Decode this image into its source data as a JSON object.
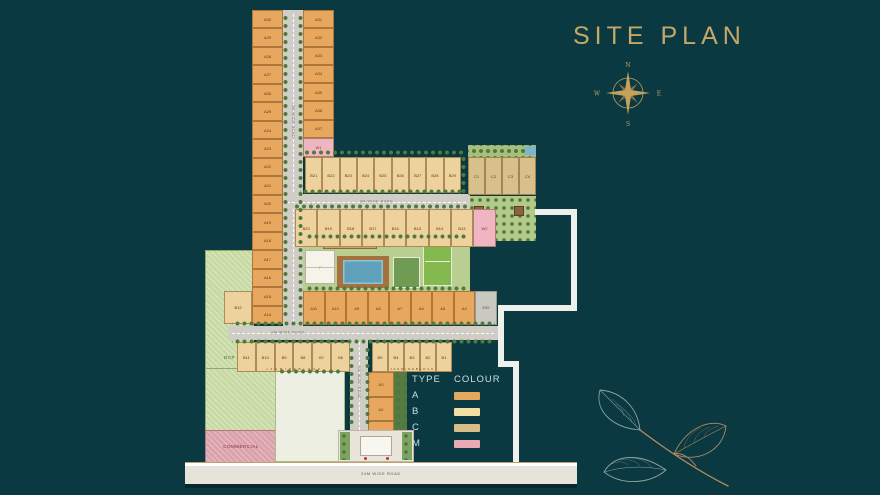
{
  "title": "SITE PLAN",
  "compass": {
    "north": "N",
    "east": "E",
    "south": "S",
    "west": "W"
  },
  "legend": {
    "type_header": "TYPE",
    "colour_header": "COLOUR",
    "rows": [
      {
        "type": "A",
        "color": "#e2a95e"
      },
      {
        "type": "B",
        "color": "#f3dfa3"
      },
      {
        "type": "C",
        "color": "#d6bd8a"
      },
      {
        "type": "M",
        "color": "#e9a9b4"
      }
    ]
  },
  "roads": {
    "internal": "9M WIDE ROAD",
    "main": "24M WIDE ROAD"
  },
  "areas": {
    "dcp": "DCP",
    "commercial": "COMMERCIAL",
    "clubhouse": "P",
    "substation": "ESS",
    "block_name": "J A S M I N E  B L O C K"
  },
  "plots": {
    "strip_left": [
      "A30",
      "A29",
      "A28",
      "A27",
      "A26",
      "A25",
      "A24",
      "A23",
      "A22",
      "A21",
      "A20",
      "A19",
      "A18",
      "A17",
      "A16",
      "A15",
      "A14"
    ],
    "strip_right": [
      "A31",
      "A32",
      "A33",
      "A34",
      "A35",
      "A36",
      "A37"
    ],
    "w1": "W1",
    "row_top": [
      "B21",
      "B22",
      "B23",
      "B24",
      "B25",
      "B26",
      "B27",
      "B28",
      "B29"
    ],
    "c_row": [
      "C1",
      "C2",
      "C3",
      "C4"
    ],
    "row_mid": [
      "B20",
      "B19",
      "B18",
      "B17",
      "B16",
      "B15",
      "B14",
      "B13"
    ],
    "w2": "W2",
    "row_a": [
      "A11",
      "A10",
      "A9",
      "A8",
      "A7",
      "A6",
      "A5",
      "A4"
    ],
    "b12": "B12",
    "bottom_left": [
      "B11",
      "B10",
      "B9",
      "B8",
      "B7",
      "B6"
    ],
    "bottom_right": [
      "B5",
      "B4",
      "B3",
      "B2",
      "B1"
    ],
    "col_bottom": [
      "A3",
      "A2",
      "A1"
    ]
  },
  "colors": {
    "background": "#0a3942",
    "title_gold": "#c7a767",
    "road": "#d0cdc6",
    "pool": "#5fa0bb",
    "boundary_white": "#eef0ec"
  }
}
